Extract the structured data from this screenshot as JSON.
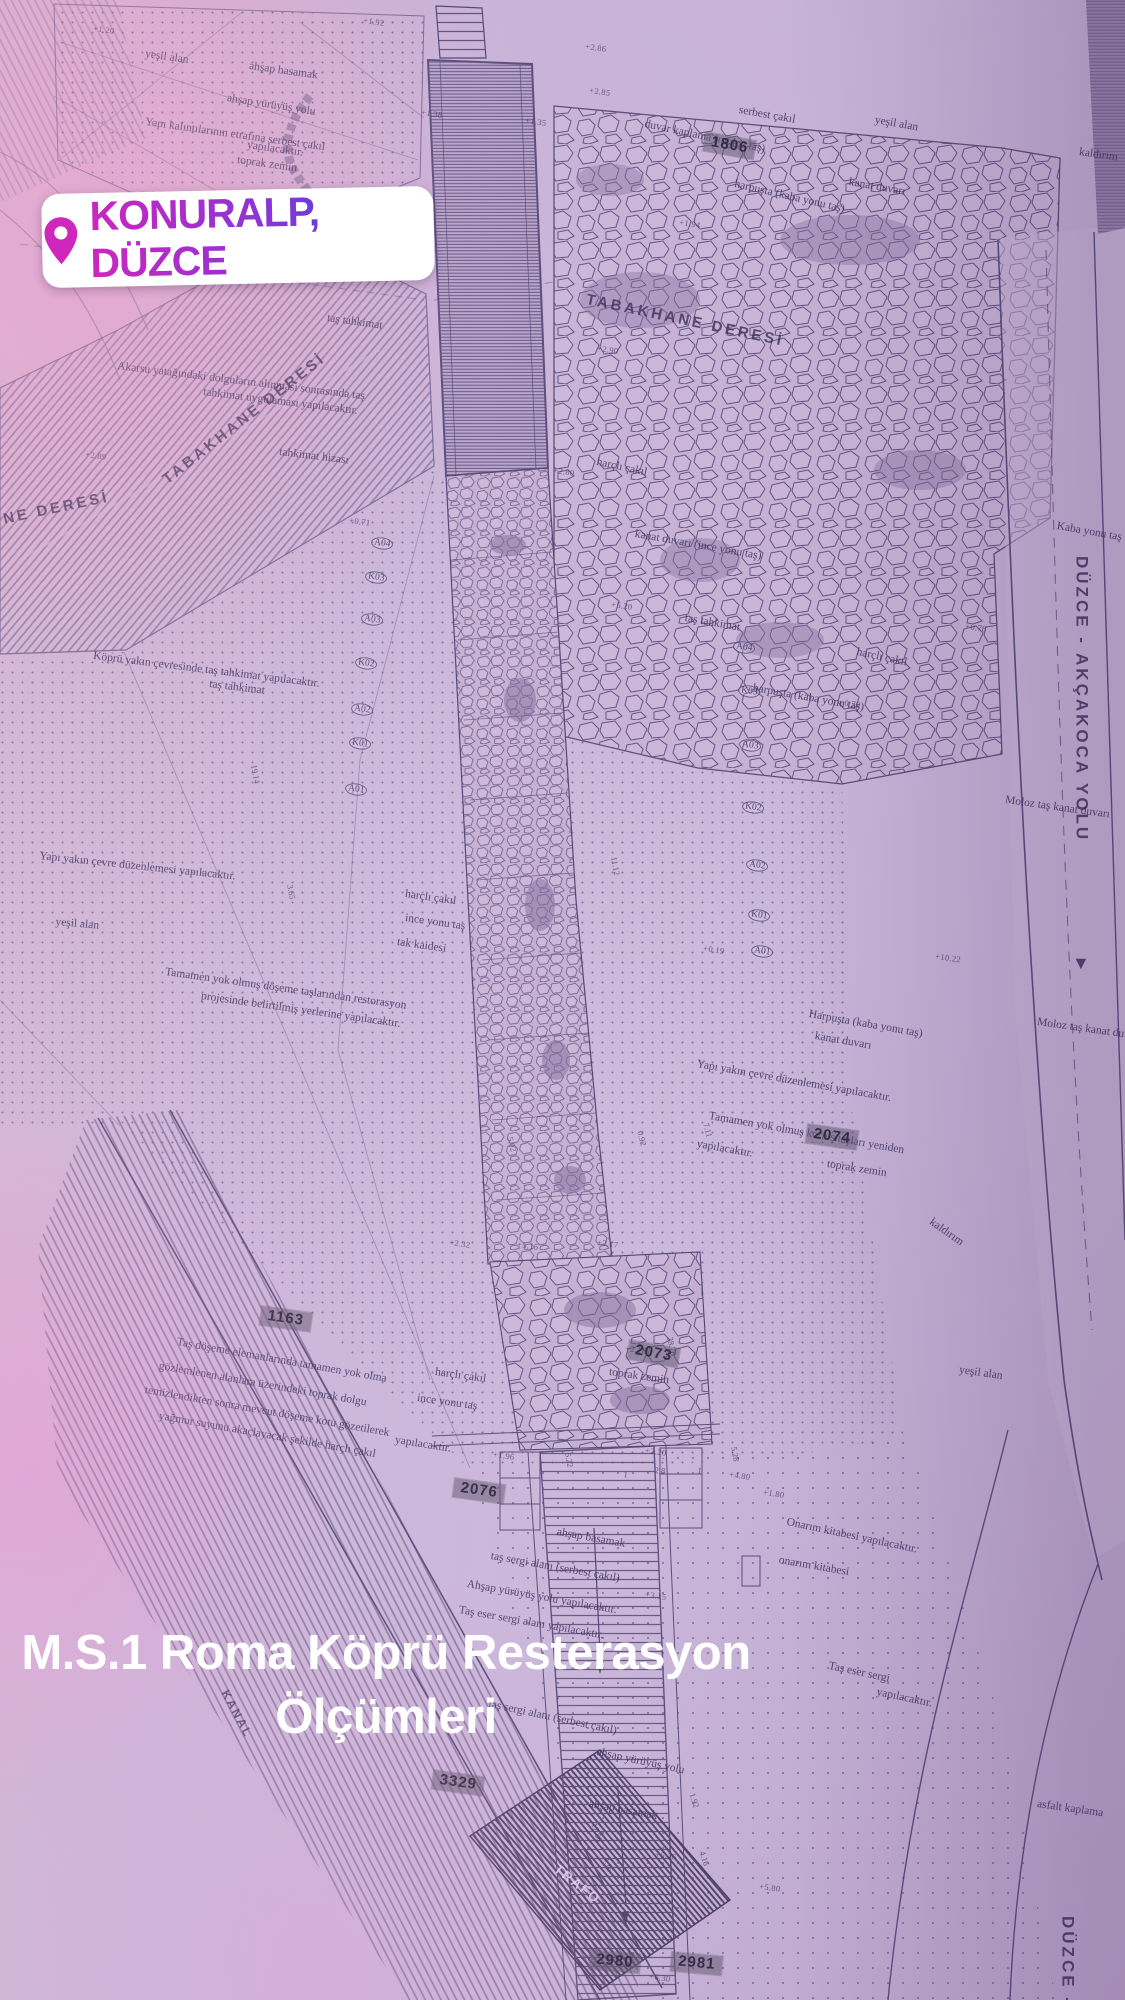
{
  "sticker": {
    "label": "KONURALP, DÜZCE",
    "icon": "location-pin"
  },
  "title": {
    "line1": "M.S.1 Roma Köprü Resterasyon",
    "line2": "Ölçümleri"
  },
  "colors": {
    "sticker_gradient_start": "#cb27bd",
    "sticker_gradient_mid": "#8f33d6",
    "sticker_gradient_end": "#2e4fe0",
    "paper_tint": "#c9b3d6",
    "ink": "#453a66"
  },
  "plan": {
    "streams": [
      "TABAKHANE DERESİ",
      "TABAKHANE DERESİ",
      "NE DERESİ",
      "KANAL"
    ],
    "road": {
      "name": "DÜZCE - AKÇAKOCA YOLU",
      "arrow": "▼",
      "name_bottom": "DÜZCE -"
    },
    "trafo": "TRAFO",
    "notes": [
      "yeşil alan",
      "ahşap basamak",
      "ahşap yürüyüş yolu",
      "Yapı kalıntılarının etrafına serbest çakıl",
      "yapılacaktır.",
      "toprak zemin",
      "serbest çakıl",
      "duvar kaplama (moloz taş)",
      "yeşil alan",
      "kaldırım",
      "harpuşta (kaba yonu taş)",
      "kanat duvarı",
      "kanat duvarı",
      "Akarsu yatağındaki dolguların alınması sonrasında taş",
      "tahkimat uygulaması yapılacaktır.",
      "tahkimat hizası",
      "taş tahkimat",
      "Köprü yakın çevresinde taş tahkimat yapılacaktır.",
      "taş tahkimat",
      "harçlı çakıl",
      "kanat duvarı (ince yonu taş)",
      "taş tahkimat",
      "harçlı çakıl",
      "Kaba yonu taş",
      "harpuşta (kaba yonu taş)",
      "Moloz taş kanat duvarı",
      "Harpuşta (kaba yonu taş)",
      "kanat duvarı",
      "Moloz taş kanat duvarı",
      "Yapı yakın çevre düzenlemesi yapılacaktır.",
      "Tamamen yok olmuş korniş taşları yeniden",
      "yapılacaktır.",
      "toprak zemin",
      "Yapı yakın çevre düzenlemesi yapılacaktır.",
      "yeşil alan",
      "harçlı çakıl",
      "ince yonu taş",
      "tak kaidesi",
      "Tamamen yok olmuş döşeme taşlarından restorasyon",
      "projesinde belirtilmiş yerlerine yapılacaktır.",
      "kaldırım",
      "yeşil alan",
      "harçlı çakıl",
      "ince yonu taş",
      "toprak zemin",
      "Taş döşeme elemanlarında tamamen yok olma",
      "gözlemlenen alanlara üzerindeki toprak dolgu",
      "temizlendikten sonra mevcut döşeme kotu gözetilerek",
      "yağmur suyunu akaçlayacak şekilde harçlı çakıl",
      "yapılacaktır.",
      "ahşap basamak",
      "taş sergi alanı (serbest çakıl)",
      "Ahşap yürüyüş yolu yapılacaktır.",
      "Taş eser sergi alanı yapılacaktır.",
      "Onarım kitabesi yapılacaktır.",
      "onarım kitabesi",
      "Taş eser sergi",
      "yapılacaktır.",
      "taş sergi alanı (serbest çakıl)",
      "ahşap yürüyüş yolu",
      "ahşap basamak",
      "asfalt kaplama"
    ],
    "elevations": [
      "+1.20",
      "+1.92",
      "+2.86",
      "+2.85",
      "+1.38",
      "+1.35",
      "+1.94",
      "+2.90",
      "+2.80",
      "+2.89",
      "+0.71",
      "+5.20",
      "+0.78",
      "+0.79",
      "+10.22",
      "+0.19",
      "+2.18",
      "+1.96",
      "+2.20",
      "+3.15",
      "+4.80",
      "+1.80",
      "+5.26",
      "+5.80",
      "+6.30",
      "+5.15",
      "+2.17",
      "+2.32"
    ],
    "dimensions": [
      "5.22",
      "5.28",
      "2.8",
      "1",
      "1",
      "11.12",
      "7.11",
      "0.92",
      "5.02",
      "28.78",
      "17.86",
      "4.16",
      "4.16",
      "1.92",
      "19.14",
      "3.65"
    ],
    "axes_left": [
      "A04",
      "K03",
      "A03",
      "K02",
      "A02",
      "K01",
      "A01"
    ],
    "axes_right": [
      "A04",
      "K03",
      "A03",
      "K02",
      "A02",
      "K01",
      "A01"
    ],
    "parcels": [
      "1806",
      "1163",
      "2076",
      "2074",
      "2073",
      "3329",
      "2980",
      "2981"
    ]
  }
}
